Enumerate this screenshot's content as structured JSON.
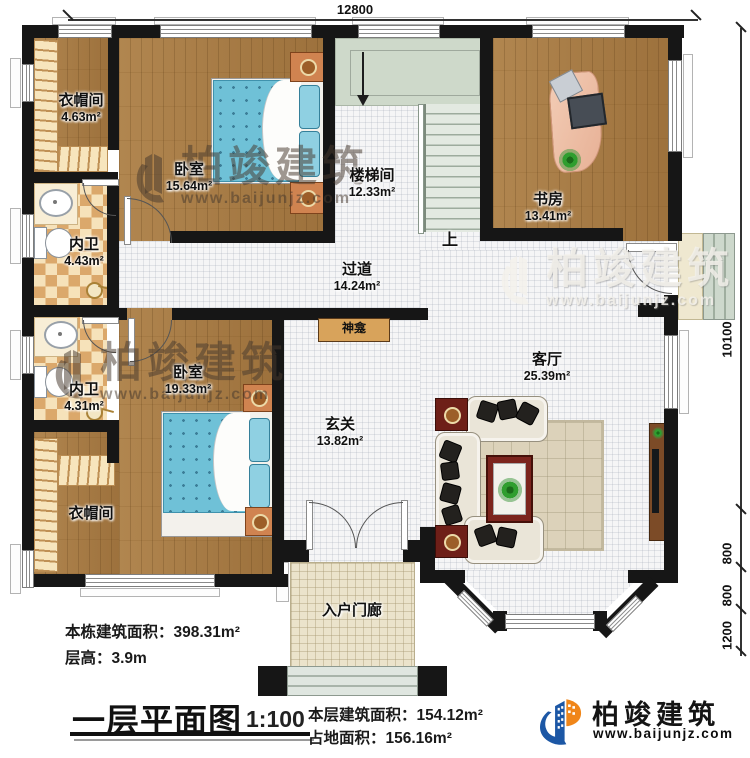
{
  "plan": {
    "dims": {
      "top": "12800",
      "right": [
        "10100",
        "800",
        "800",
        "1200"
      ]
    },
    "rooms": {
      "cloak1": {
        "name": "衣帽间",
        "area": "4.63m²"
      },
      "bedroom1": {
        "name": "卧室",
        "area": "15.64m²"
      },
      "stairwell": {
        "name": "楼梯间",
        "area": "12.33m²"
      },
      "study": {
        "name": "书房",
        "area": "13.41m²"
      },
      "bath1": {
        "name": "内卫",
        "area": "4.43m²"
      },
      "corridor": {
        "name": "过道",
        "area": "14.24m²"
      },
      "bath2": {
        "name": "内卫",
        "area": "4.31m²"
      },
      "bedroom2": {
        "name": "卧室",
        "area": "19.33m²"
      },
      "hall": {
        "name": "玄关",
        "area": "13.82m²"
      },
      "living": {
        "name": "客厅",
        "area": "25.39m²"
      },
      "cloak2": {
        "name": "衣帽间"
      },
      "porch": {
        "name": "入户门廊"
      },
      "shrine": {
        "name": "神龛"
      },
      "stairs_up": {
        "name": "上"
      }
    }
  },
  "titleblock": {
    "total_area": "本栋建筑面积：398.31m²",
    "floor_height": "层高：3.9m",
    "title": "一层平面图",
    "scale": "1:100",
    "floor_area": "本层建筑面积：154.12m²",
    "footprint_area": "占地面积：156.16m²"
  },
  "brand": {
    "name": "柏竣建筑",
    "url": "www.baijunjz.com"
  },
  "watermark": {
    "name": "柏竣建筑",
    "url": "www.baijunjz.com"
  }
}
